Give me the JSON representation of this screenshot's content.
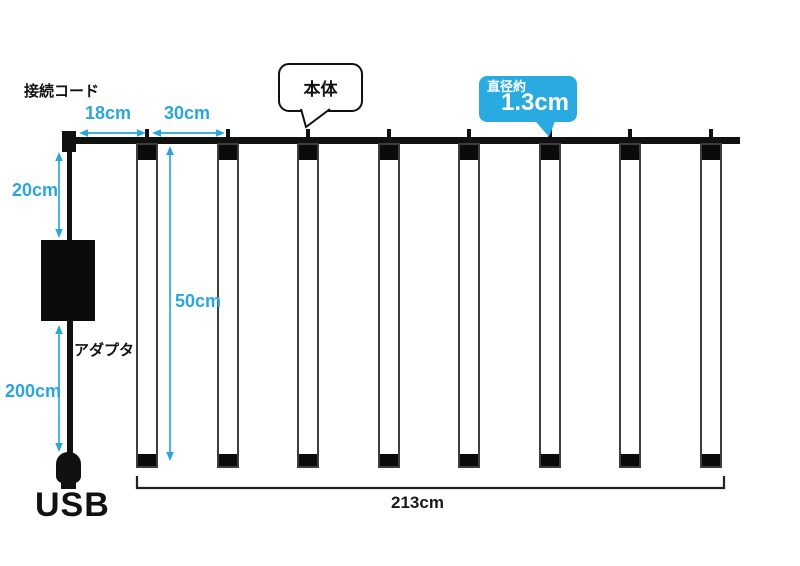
{
  "title": "LED tube curtain light dimension diagram",
  "labels": {
    "connection_cord": "接続コード",
    "main_body": "本体",
    "adapter": "アダプタ",
    "usb": "USB"
  },
  "badge": {
    "caption": "直径約",
    "value": "1.3cm",
    "color": "#29abe2"
  },
  "measurements": {
    "end_to_first_tube": "18cm",
    "tube_spacing": "30cm",
    "cord_drop_to_adapter": "20cm",
    "adapter_to_plug": "200cm",
    "tube_length": "50cm",
    "total_width": "213cm"
  },
  "tubes": {
    "count": 8
  },
  "colors": {
    "accent_cyan": "#2ba6db",
    "badge_blue": "#29abe2",
    "diagram_black": "#111111"
  }
}
